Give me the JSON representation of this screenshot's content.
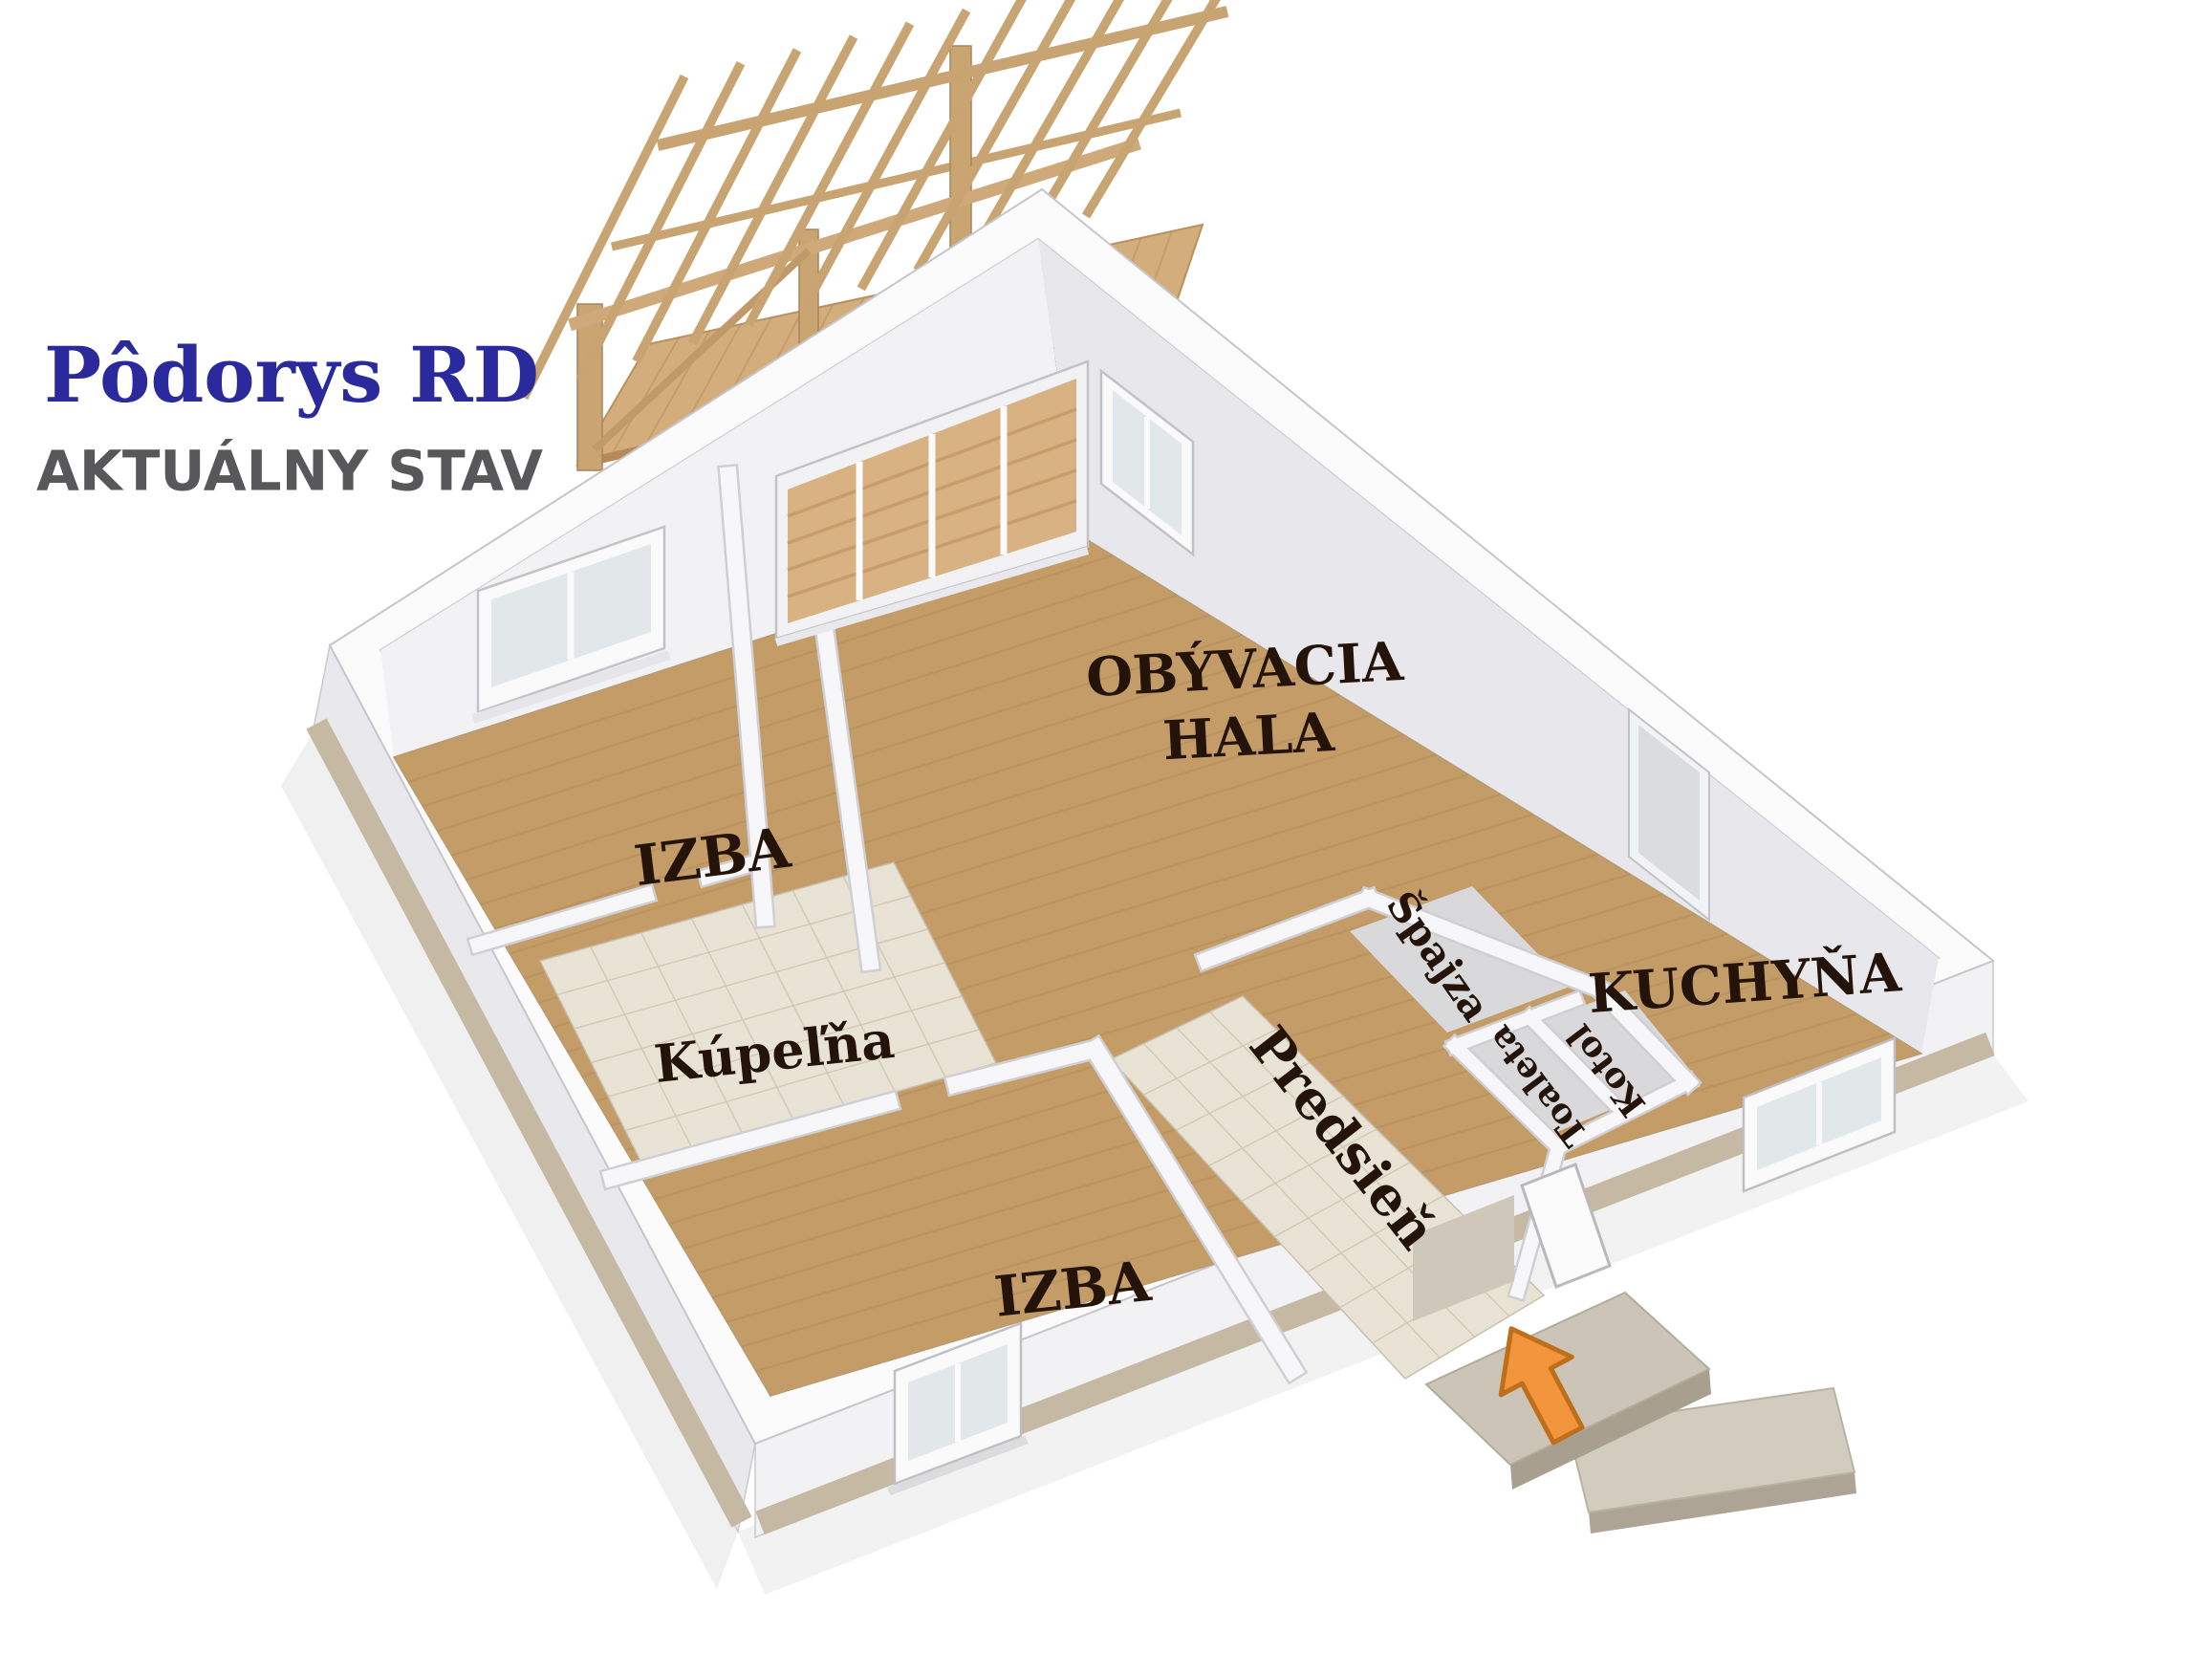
{
  "header": {
    "title": "Pôdorys RD",
    "subtitle": "AKTUÁLNY STAV",
    "title_color": "#2a2a9c",
    "subtitle_color": "#58585a"
  },
  "plan": {
    "terrace": {
      "label": "Krytá terasa",
      "label_color": "#1d1d1d"
    },
    "rooms": {
      "izba1": {
        "label": "IZBA"
      },
      "hala": {
        "label": "OBÝVACIA HALA",
        "line1": "OBÝVACIA",
        "line2": "HALA"
      },
      "kupelna": {
        "label": "Kúpeľňa"
      },
      "izba2": {
        "label": "IZBA"
      },
      "kuchyna": {
        "label": "KUCHYŇA"
      },
      "predsien": {
        "label": "Predsieň"
      },
      "spajza": {
        "label": "Špajza"
      },
      "toaleta": {
        "label": "Toaleta"
      },
      "kotol": {
        "label": "Kotol"
      }
    },
    "label_color": "#241309",
    "entrance_arrow_color": "#f2953d",
    "entrance_arrow_outline": "#bd6f1c",
    "materials": {
      "wood_floor": "#c49c68",
      "wood_plank_line": "#a97f4c",
      "deck_wood": "#d3ad7c",
      "deck_plank_line": "#b9905f",
      "pergola_wood": "#c9a473",
      "pergola_post": "#c9a572",
      "tile": "#e9e3d5",
      "tile_line": "#cdc4b0",
      "small_room_floor": "#d9d9db",
      "wall_top": "#fbfbfc",
      "wall_edge": "#c6c6ca",
      "wall_face_light": "#f2f2f5",
      "wall_face_shadow": "#e8e8ec",
      "exterior_face_sw": "#e9e9ed",
      "exterior_face_se": "#f2f2f4",
      "plinth": "#c5b9a4",
      "glass": "#e2e7ea",
      "step_top": "#ccc5b7",
      "step_side": "#a89f8e"
    }
  }
}
